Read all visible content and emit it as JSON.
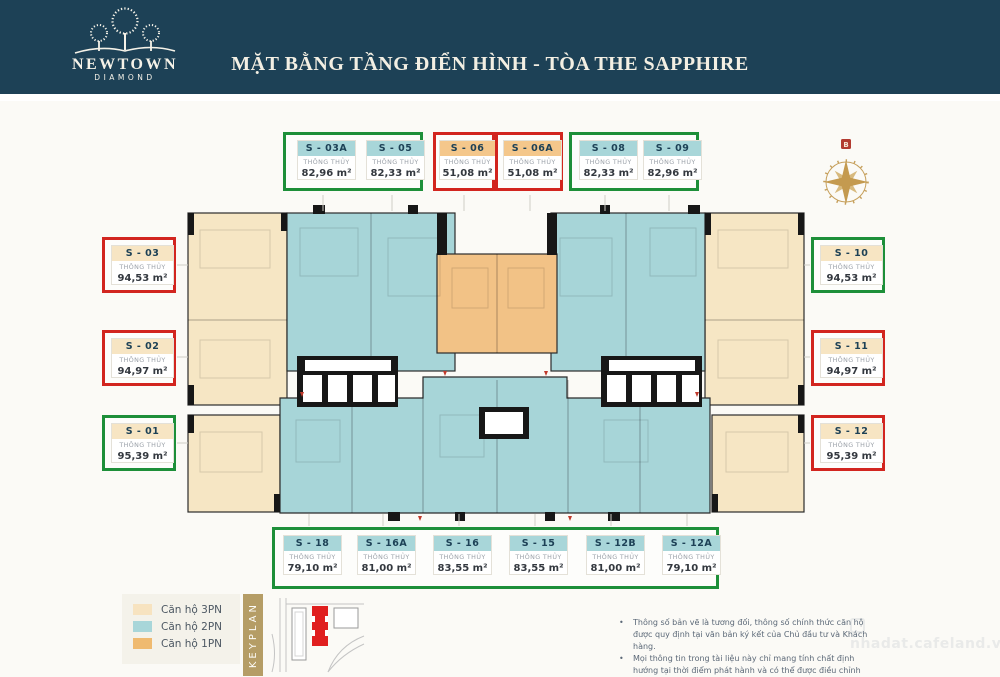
{
  "header": {
    "logo_line1": "NEWTOWN",
    "logo_line2": "DIAMOND",
    "title": "MẶT BẰNG TẦNG ĐIỂN HÌNH - TÒA THE SAPPHIRE"
  },
  "compass": {
    "north_label": "B"
  },
  "units": {
    "spec_label": "THÔNG THỦY",
    "groups": [
      {
        "id": "top-1",
        "border": "green",
        "cards": [
          {
            "label": "S - 03A",
            "area": "82,96 m²",
            "type": "2PN"
          },
          {
            "label": "S - 05",
            "area": "82,33 m²",
            "type": "2PN"
          }
        ]
      },
      {
        "id": "top-2",
        "border": "red",
        "cards": [
          {
            "label": "S - 06",
            "area": "51,08 m²",
            "type": "1PN"
          }
        ]
      },
      {
        "id": "top-3",
        "border": "red",
        "cards": [
          {
            "label": "S - 06A",
            "area": "51,08 m²",
            "type": "1PN"
          }
        ]
      },
      {
        "id": "top-4",
        "border": "green",
        "cards": [
          {
            "label": "S - 08",
            "area": "82,33 m²",
            "type": "2PN"
          },
          {
            "label": "S - 09",
            "area": "82,96 m²",
            "type": "2PN"
          }
        ]
      },
      {
        "id": "left-1",
        "border": "red",
        "cards": [
          {
            "label": "S - 03",
            "area": "94,53 m²",
            "type": "3PN"
          }
        ]
      },
      {
        "id": "left-2",
        "border": "red",
        "cards": [
          {
            "label": "S - 02",
            "area": "94,97 m²",
            "type": "3PN"
          }
        ]
      },
      {
        "id": "left-3",
        "border": "green",
        "cards": [
          {
            "label": "S - 01",
            "area": "95,39 m²",
            "type": "3PN"
          }
        ]
      },
      {
        "id": "right-1",
        "border": "green",
        "cards": [
          {
            "label": "S - 10",
            "area": "94,53 m²",
            "type": "3PN"
          }
        ]
      },
      {
        "id": "right-2",
        "border": "red",
        "cards": [
          {
            "label": "S - 11",
            "area": "94,97 m²",
            "type": "3PN"
          }
        ]
      },
      {
        "id": "right-3",
        "border": "red",
        "cards": [
          {
            "label": "S - 12",
            "area": "95,39 m²",
            "type": "3PN"
          }
        ]
      },
      {
        "id": "bottom-1",
        "border": "green",
        "cards": [
          {
            "label": "S - 18",
            "area": "79,10 m²",
            "type": "2PN"
          },
          {
            "label": "S - 16A",
            "area": "81,00 m²",
            "type": "2PN"
          },
          {
            "label": "S - 16",
            "area": "83,55 m²",
            "type": "2PN"
          },
          {
            "label": "S - 15",
            "area": "83,55 m²",
            "type": "2PN"
          },
          {
            "label": "S - 12B",
            "area": "81,00 m²",
            "type": "2PN"
          },
          {
            "label": "S - 12A",
            "area": "79,10 m²",
            "type": "2PN"
          }
        ]
      }
    ]
  },
  "legend": {
    "items": [
      {
        "label": "Căn hộ 3PN",
        "color": "#f7e3c0"
      },
      {
        "label": "Căn hộ 2PN",
        "color": "#a8d6d9"
      },
      {
        "label": "Căn hộ 1PN",
        "color": "#efba70"
      }
    ],
    "keyplan_label": "KEYPLAN"
  },
  "notes": [
    "Thông số bản vẽ là tương đối, thông số chính thức căn hộ được quy định tại văn bản ký kết của Chủ đầu tư và Khách hàng.",
    "Mọi thông tin trong tài liệu này chỉ mang tính chất định hướng tại thời điểm phát hành và có thể được điều chỉnh mà không cần báo trước."
  ],
  "watermark": "nhadat.cafeland.vn",
  "colors": {
    "header_bg": "#1d4156",
    "title_text": "#f3efe3",
    "group_green": "#1d8f39",
    "group_red": "#d2251f",
    "type_colors": {
      "3PN": "#f7e5c3",
      "2PN": "#a8d6d9",
      "1PN": "#f4c78b"
    },
    "plan_beige": "#f6e6c4",
    "plan_teal": "#a7d5d8",
    "plan_orange": "#f2c286",
    "wall": "#171717",
    "gold": "#b59d66",
    "keyplan_red": "#e01f1f"
  }
}
